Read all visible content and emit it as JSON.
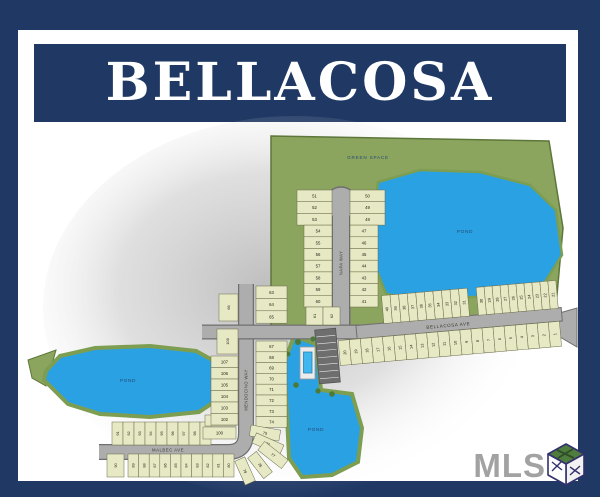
{
  "header": {
    "title": "BELLACOSA"
  },
  "watermark": {
    "label": "MLS",
    "icon": "mls-cube-icon"
  },
  "colors": {
    "frame_navy": "#1f3864",
    "page_white": "#ffffff",
    "green_space": "#8ca55e",
    "green_edge": "#5c763b",
    "pond_blue": "#2aa1e2",
    "pond_fringe": "#7d9e50",
    "lot_fill": "#e7e9c4",
    "lot_edge": "#6b6b4a",
    "street_fill": "#adadad",
    "street_edge": "#6f6f6f",
    "parking_gray": "#6e6e6e",
    "label_navy": "#244a75",
    "number_ink": "#26261a",
    "watermark_gray": "#a2a2a2"
  },
  "map": {
    "labels": {
      "green_space": "GREEN SPACE"
    },
    "ponds": [
      {
        "label": "POND"
      },
      {
        "label": "POND"
      },
      {
        "label": "POND"
      }
    ],
    "streets": {
      "napa": "NAPA WAY",
      "mendocino": "MENDOCINO WAY",
      "malbec": "MALBEC AVE",
      "bellacosa": "BELLACOSA AVE"
    },
    "lots": {
      "napa_left": [
        "51",
        "52",
        "53",
        "54",
        "55",
        "56",
        "57",
        "58",
        "59",
        "60"
      ],
      "napa_right": [
        "50",
        "49",
        "48",
        "47",
        "46",
        "45",
        "44",
        "43",
        "42",
        "41"
      ],
      "connector_pair": [
        "61",
        "62"
      ],
      "mendocino_east_upper": [
        "63",
        "64",
        "65"
      ],
      "mendocino_west_single": [
        "66"
      ],
      "mendocino_east": [
        "67",
        "68",
        "69",
        "70",
        "71",
        "72",
        "73",
        "74"
      ],
      "curve_lots": [
        "75",
        "76",
        "77"
      ],
      "diagonal_lots": [
        "78",
        "79"
      ],
      "malbec_south": [
        "89",
        "88",
        "87",
        "86",
        "85",
        "84",
        "83",
        "82",
        "81",
        "80"
      ],
      "malbec_south_end": [
        "90"
      ],
      "malbec_north": [
        "91",
        "92",
        "93",
        "94",
        "95",
        "96",
        "97",
        "98",
        "99"
      ],
      "corner_lots": [
        "101",
        "100"
      ],
      "mendocino_west_top": [
        "108"
      ],
      "mendocino_west": [
        "107",
        "106",
        "105",
        "104",
        "103",
        "102"
      ],
      "bellacosa_north_west": [
        "40",
        "39",
        "38",
        "37",
        "36",
        "35",
        "34",
        "33",
        "32",
        "31"
      ],
      "bellacosa_north_east": [
        "30",
        "29",
        "28",
        "27",
        "26",
        "25",
        "24",
        "23",
        "22",
        "21"
      ],
      "bellacosa_south": [
        "20",
        "19",
        "18",
        "17",
        "16",
        "15",
        "14",
        "13",
        "12",
        "11",
        "10",
        "9",
        "8",
        "7",
        "6",
        "5",
        "4",
        "3",
        "2",
        "1"
      ]
    }
  }
}
